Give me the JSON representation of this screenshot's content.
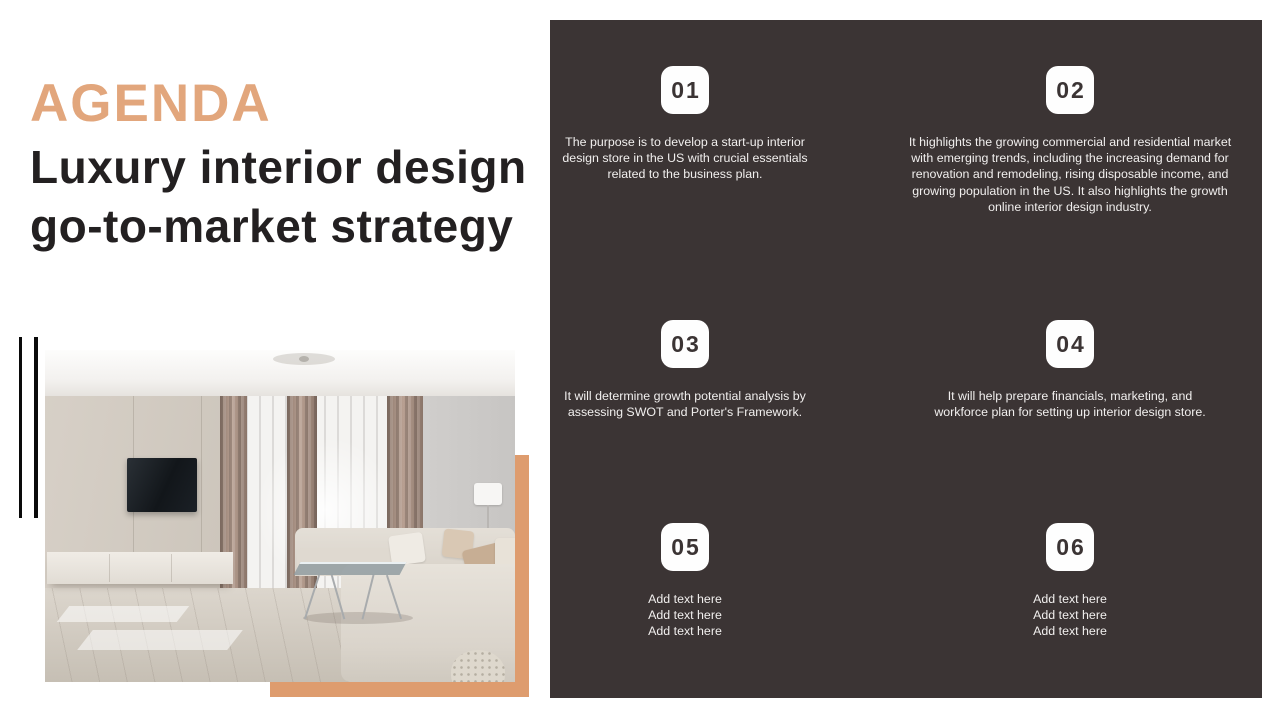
{
  "slide": {
    "heading": "AGENDA",
    "title": "Luxury interior design\ngo-to-market strategy"
  },
  "panel": {
    "items": [
      {
        "number": "01",
        "text": "The purpose is to develop a start-up interior\ndesign store in the US with crucial essentials\nrelated to the business plan."
      },
      {
        "number": "02",
        "text": "It highlights the growing commercial and residential market\nwith emerging trends, including the increasing demand for\nrenovation and remodeling, rising disposable income, and\ngrowing population in the US. It also highlights the growth\nonline interior design industry."
      },
      {
        "number": "03",
        "text": "It will determine growth potential analysis by\nassessing SWOT and Porter's Framework."
      },
      {
        "number": "04",
        "text": "It will help prepare financials, marketing, and\nworkforce plan for setting up interior design store."
      },
      {
        "number": "05",
        "text": "Add text here\nAdd text here\nAdd text here"
      },
      {
        "number": "06",
        "text": "Add text here\nAdd text here\nAdd text here"
      }
    ]
  },
  "colors": {
    "accent_title": "#E2A67C",
    "accent_rectangle": "#DE9C6E",
    "panel_background": "#3B3434",
    "badge_background": "#FEFEFE",
    "text_on_dark": "#F1EFEE",
    "title_text": "#232021"
  }
}
